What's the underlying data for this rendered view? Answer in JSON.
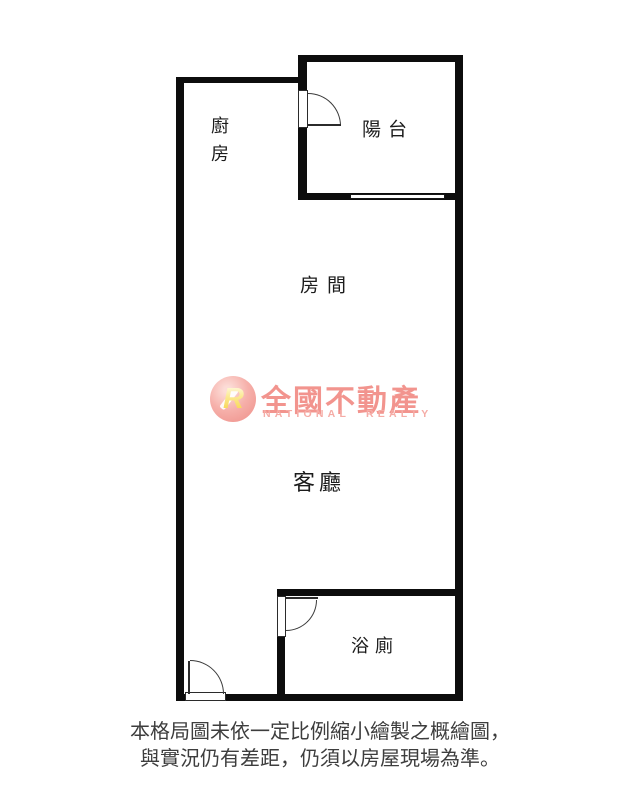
{
  "floorplan": {
    "wall_color": "#0d0d0d",
    "rooms": [
      {
        "id": "kitchen",
        "label": "廚房"
      },
      {
        "id": "balcony",
        "label": "陽台"
      },
      {
        "id": "bedroom",
        "label": "房間"
      },
      {
        "id": "living",
        "label": "客廳"
      },
      {
        "id": "bathroom",
        "label": "浴廁"
      }
    ]
  },
  "watermark": {
    "logo_monogram": "R",
    "brand_cn": "全國不動產",
    "brand_en": "NATIONAL REALTY",
    "color_primary": "#f2948e",
    "color_secondary": "#f5aca6",
    "monogram_color": "#f6cf3f"
  },
  "disclaimer": {
    "line1": "本格局圖未依一定比例縮小繪製之概繪圖，",
    "line2": "與實況仍有差距，仍須以房屋現場為準。"
  }
}
